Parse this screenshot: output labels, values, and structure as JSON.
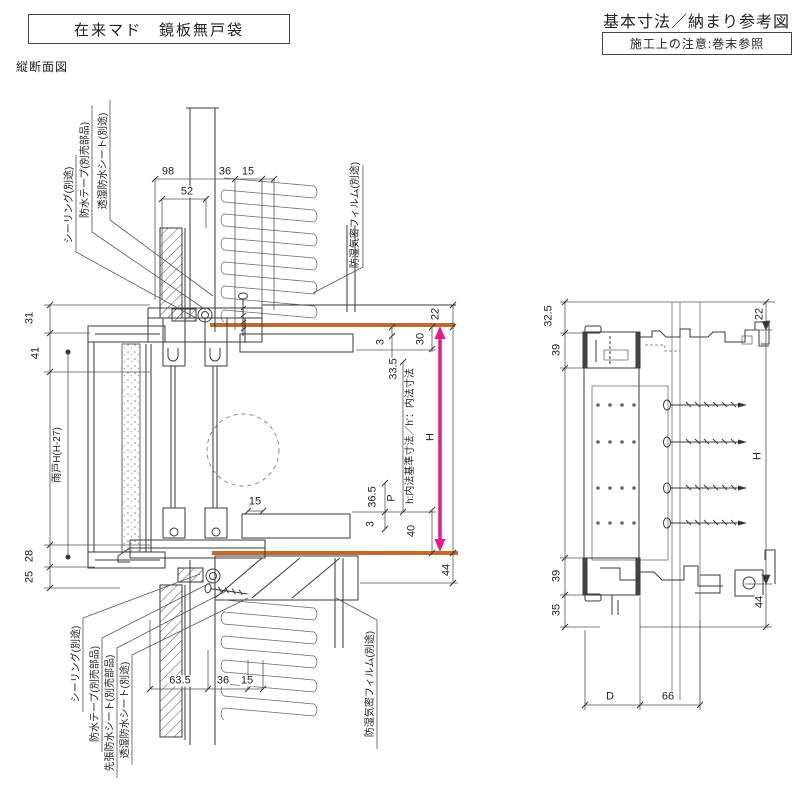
{
  "page": {
    "product_title": "在来マド　鏡板無戸袋",
    "doc_title": "基本寸法／納まり参考図",
    "note": "施工上の注意:巻末参照",
    "section_label": "縦断面図"
  },
  "colors": {
    "orange": "#c06a2e",
    "magenta": "#e8198d",
    "line": "#3a3a3a"
  },
  "vertical_section": {
    "callouts": {
      "sealing_top": "シーリング(別途)",
      "tape_top": "防水テープ(別売部品)",
      "sheet_top": "透湿防水シート(別途)",
      "film_top": "防湿気密フィルム(別途)",
      "sealing_bottom": "シーリング(別途)",
      "tape_bottom": "防水テープ(別売部品)",
      "pre_sheet_bottom": "先張防水シート(別売部品)",
      "sheet_bottom": "透湿防水シート(別途)",
      "film_bottom": "防湿気密フィルム(別途)"
    },
    "dims": {
      "top_98": "98",
      "top_52": "52",
      "top_36": "36",
      "top_15": "15",
      "left_31": "31",
      "left_41": "41",
      "left_shutter": "雨戸H(H-27)",
      "left_28": "28",
      "left_25": "25",
      "right_22": "22",
      "right_30": "30",
      "right_3_top": "3",
      "right_33_5": "33.5",
      "right_H": "H",
      "right_P": "P",
      "mid_15": "15",
      "right_36_5": "36.5",
      "right_3_bottom": "3",
      "right_40": "40",
      "right_44": "44",
      "inner_note": "h:内法基準寸法／h'：内法寸法",
      "bottom_63_5": "63.5",
      "bottom_36": "36",
      "bottom_15": "15"
    }
  },
  "side_section": {
    "dims": {
      "left_32_5": "32.5",
      "left_39_top": "39",
      "left_39_bottom": "39",
      "left_35": "35",
      "right_22": "22",
      "right_H": "H",
      "right_44": "44",
      "bottom_D": "D",
      "bottom_66": "66"
    }
  }
}
